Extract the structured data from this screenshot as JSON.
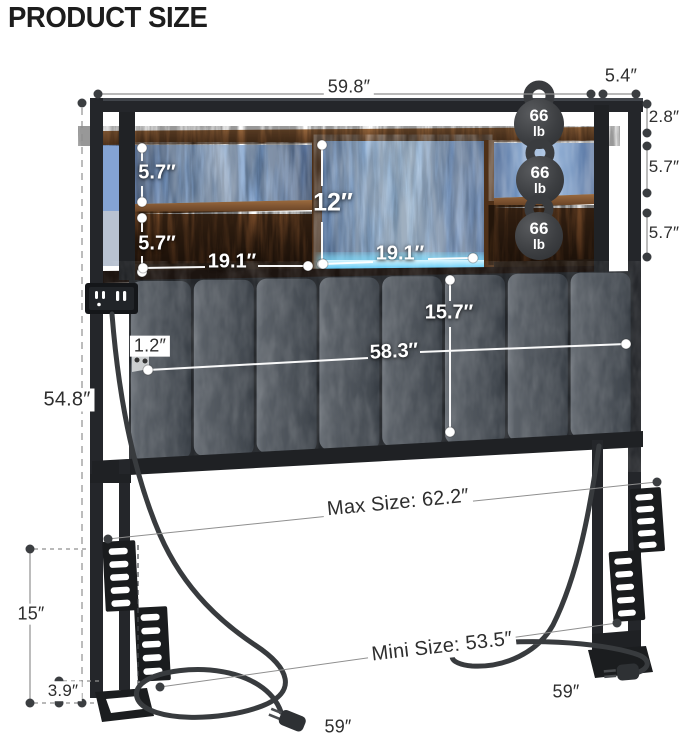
{
  "title": "PRODUCT SIZE",
  "capacity_badge": {
    "weight": "66",
    "unit": "lb"
  },
  "dims": {
    "top_width": "59.8″",
    "top_depth": "5.4″",
    "right_top_offset": "2.8″",
    "right_shelf_upper": "5.7″",
    "right_shelf_lower": "5.7″",
    "left_shelf_upper": "5.7″",
    "left_shelf_lower": "5.7″",
    "left_cubby_width": "19.1″",
    "center_cubby_height": "12″",
    "center_cubby_width": "19.1″",
    "headboard_panel_height": "15.7″",
    "headboard_width": "58.3″",
    "panel_thickness": "1.2″",
    "overall_height": "54.8″",
    "leg_height": "15″",
    "foot_height": "3.9″",
    "max_size": "Max Size: 62.2″",
    "mini_size": "Mini Size: 53.5″",
    "left_cord_length": "59″",
    "right_cord_length": "59″"
  },
  "colors": {
    "led_accent": "#57c8f2",
    "wood": "#6b4527",
    "metal": "#24262a",
    "cushion": "#4a5057"
  }
}
